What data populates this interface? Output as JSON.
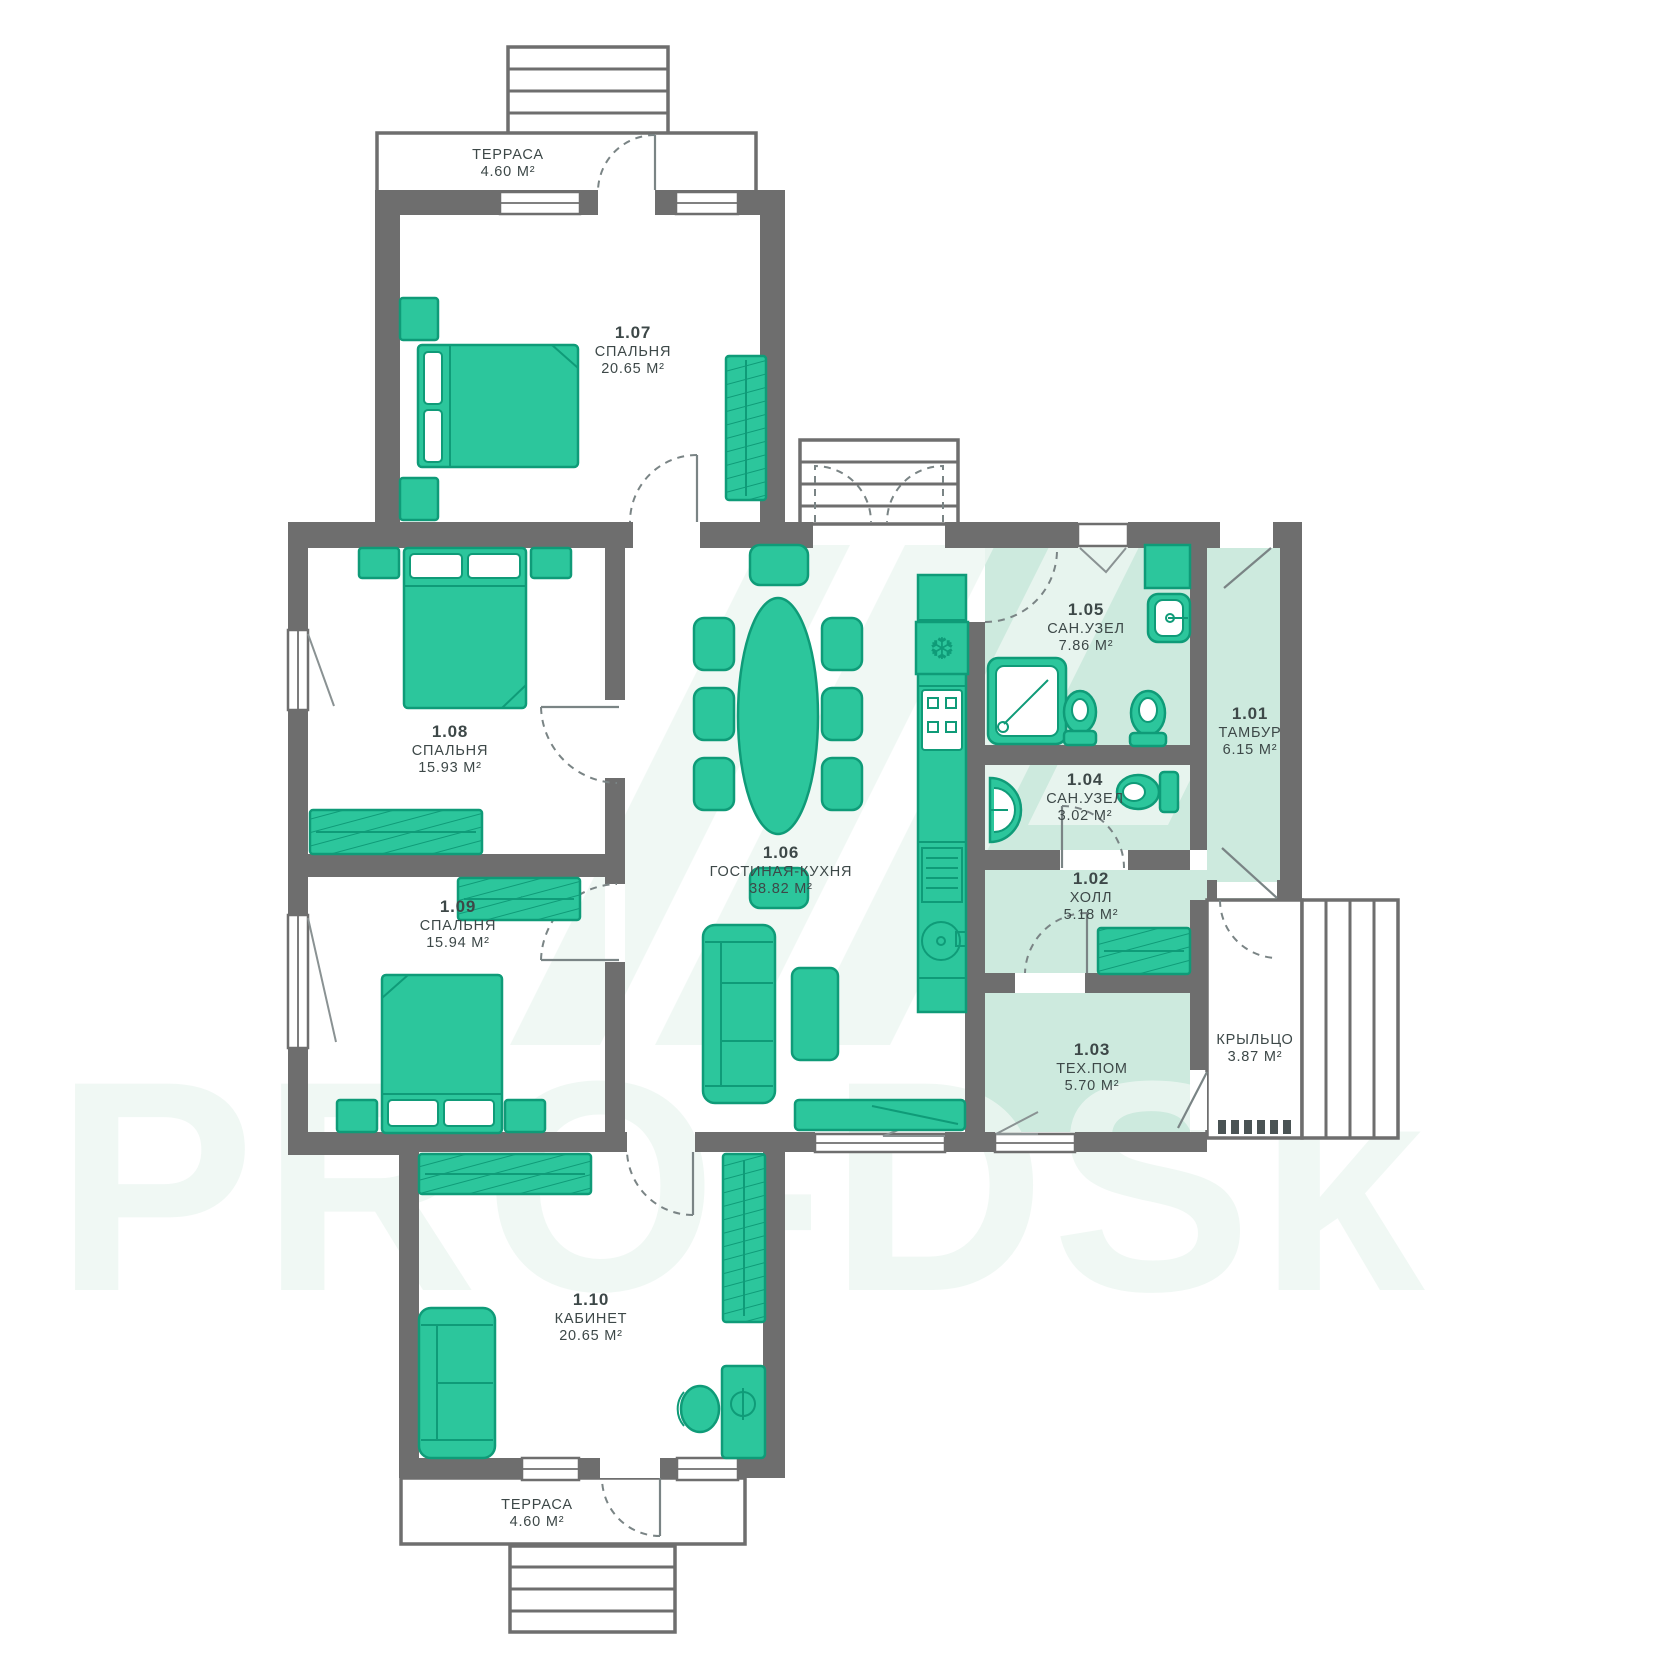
{
  "watermark": {
    "text": "PRO-DSk"
  },
  "icons": {
    "fridge": "❆"
  },
  "colors": {
    "wall": "#6e6e6e",
    "furniture": "#2cc69c",
    "furniture_stroke": "#0f9b78",
    "room_tint": "#cdeade",
    "watermark_tint": "#edf7f2",
    "label_text": "#3d4848"
  },
  "rooms": [
    {
      "number": "1.01",
      "name": "ТАМБУР",
      "area": "6.15 М²"
    },
    {
      "number": "1.02",
      "name": "ХОЛЛ",
      "area": "5.18 М²"
    },
    {
      "number": "1.03",
      "name": "ТЕХ.ПОМ",
      "area": "5.70 М²"
    },
    {
      "number": "1.04",
      "name": "САН.УЗЕЛ",
      "area": "3.02 М²"
    },
    {
      "number": "1.05",
      "name": "САН.УЗЕЛ",
      "area": "7.86 М²"
    },
    {
      "number": "1.06",
      "name": "ГОСТИНАЯ-КУХНЯ",
      "area": "38.82 М²"
    },
    {
      "number": "1.07",
      "name": "СПАЛЬНЯ",
      "area": "20.65 М²"
    },
    {
      "number": "1.08",
      "name": "СПАЛЬНЯ",
      "area": "15.93 М²"
    },
    {
      "number": "1.09",
      "name": "СПАЛЬНЯ",
      "area": "15.94 М²"
    },
    {
      "number": "1.10",
      "name": "КАБИНЕТ",
      "area": "20.65 М²"
    },
    {
      "number": "",
      "name": "ТЕРРАСА",
      "area": "4.60 М²"
    },
    {
      "number": "",
      "name": "ТЕРРАСА",
      "area": "4.60 М²"
    },
    {
      "number": "",
      "name": "КРЫЛЬЦО",
      "area": "3.87 М²"
    }
  ]
}
